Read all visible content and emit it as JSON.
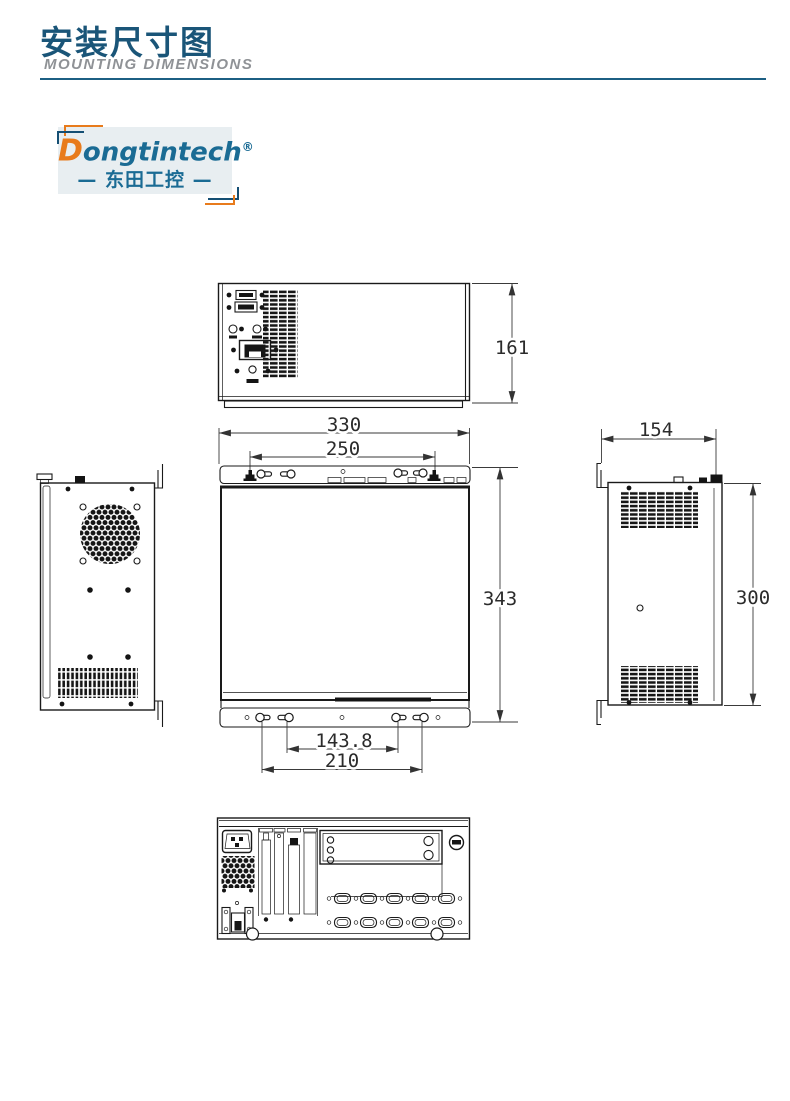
{
  "header": {
    "title": "安装尺寸图",
    "subtitle": "MOUNTING  DIMENSIONS"
  },
  "logo": {
    "brand_d": "D",
    "brand_rest": "ongtintech",
    "registered": "®",
    "chinese": "— 东田工控 —",
    "brand_blue": "#1a6b94",
    "brand_orange": "#e87b1c"
  },
  "colors": {
    "accent_blue": "#1a5578",
    "divider_blue": "#1c5f83",
    "line_black": "#1a1a1a"
  },
  "drawing": {
    "front_view": {
      "height_mm": "161"
    },
    "plan_view": {
      "width_mm": "330",
      "mount_span_mm": "250",
      "depth_mm": "343",
      "inner_hole_span_mm": "143.8",
      "outer_hole_span_mm": "210"
    },
    "side_view": {
      "width_mm": "154",
      "height_mm": "300"
    }
  }
}
